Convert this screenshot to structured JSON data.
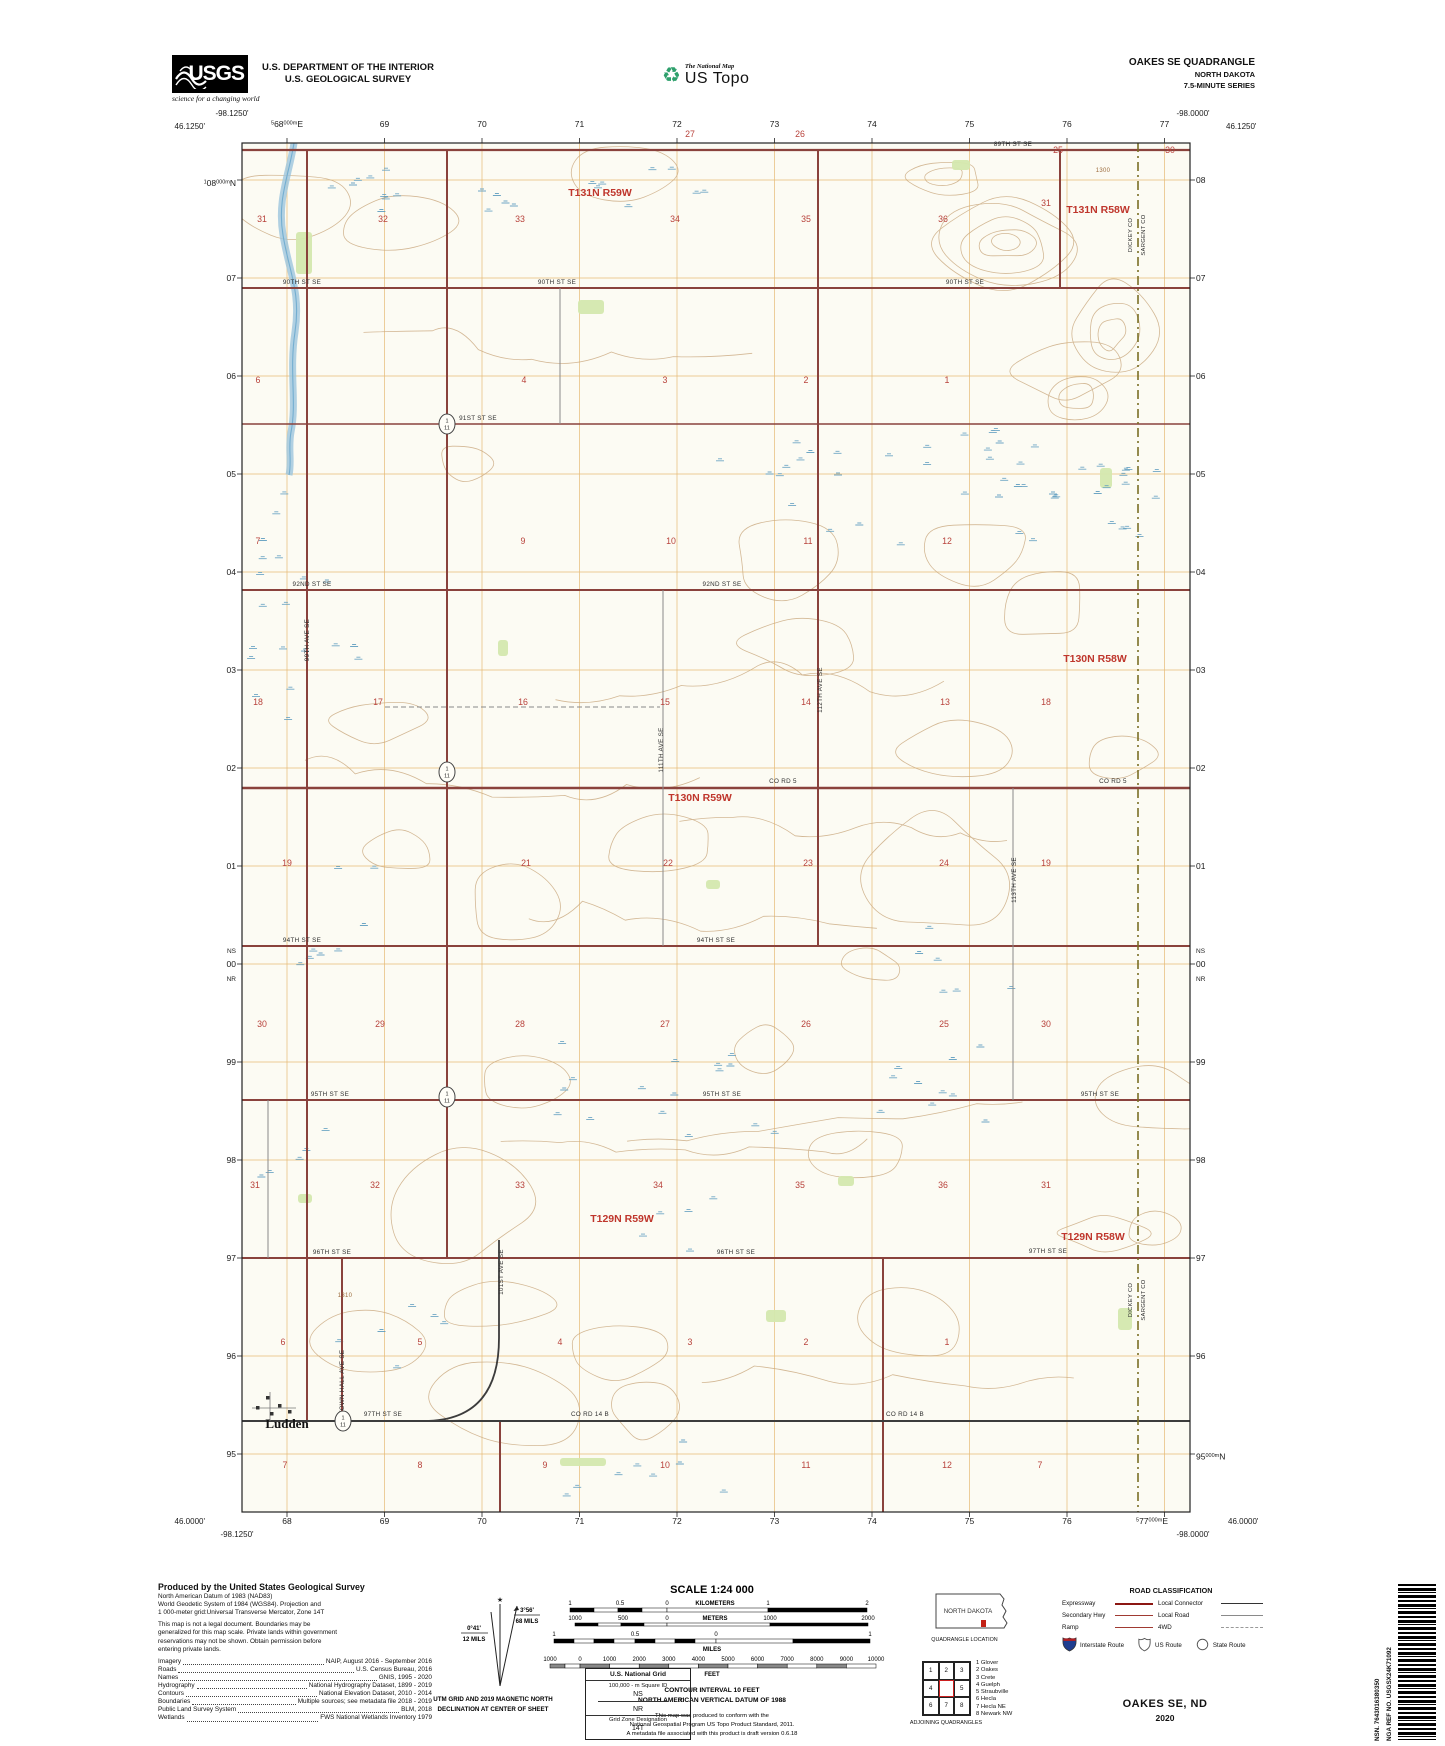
{
  "header": {
    "usgs_acronym": "USGS",
    "usgs_tagline": "science for a changing world",
    "dept_line1": "U.S. DEPARTMENT OF THE INTERIOR",
    "dept_line2": "U.S. GEOLOGICAL SURVEY",
    "tnm": "The National Map",
    "ustopo": "US Topo",
    "recycle_icon": "♻",
    "quad1": "OAKES SE QUADRANGLE",
    "quad2": "NORTH DAKOTA",
    "quad3": "7.5-MINUTE SERIES"
  },
  "map": {
    "corners": {
      "tl_lon": "-98.1250'",
      "tl_lat": "46.1250'",
      "tr_lon": "-98.0000'",
      "tr_lat": "46.1250'",
      "bl_lat": "46.0000'",
      "bl_lon": "-98.1250'",
      "br_lon": "-98.0000'",
      "br_lat": "46.0000'"
    },
    "utm": {
      "top_first": [
        "5",
        "68",
        "000m",
        "E"
      ],
      "top_rest": [
        "69",
        "70",
        "71",
        "72",
        "73",
        "74",
        "75",
        "76",
        "77"
      ],
      "bottom_rest": [
        "68",
        "69",
        "70",
        "71",
        "72",
        "73",
        "74",
        "75",
        "76"
      ],
      "bottom_last": [
        "5",
        "77",
        "000m",
        "E"
      ],
      "left_first": [
        "1",
        "08",
        "000m",
        "N"
      ],
      "left_rest": [
        "07",
        "06",
        "05",
        "04",
        "03",
        "02",
        "01",
        "00",
        "99",
        "98",
        "97",
        "96",
        "95"
      ],
      "right_rest": [
        "08",
        "07",
        "06",
        "05",
        "04",
        "03",
        "02",
        "01",
        "00",
        "99",
        "98",
        "97",
        "96"
      ],
      "right_last": [
        "",
        "95",
        "000m",
        "N"
      ],
      "ns": "NS",
      "nr": "NR"
    },
    "townships": [
      {
        "x": 600,
        "y": 196,
        "t": "T131N R59W"
      },
      {
        "x": 1098,
        "y": 213,
        "t": "T131N R58W"
      },
      {
        "x": 1095,
        "y": 662,
        "t": "T130N R58W"
      },
      {
        "x": 700,
        "y": 801,
        "t": "T130N R59W"
      },
      {
        "x": 622,
        "y": 1222,
        "t": "T129N R59W"
      },
      {
        "x": 1093,
        "y": 1240,
        "t": "T129N R58W"
      }
    ],
    "margin_sections": [
      {
        "n": "27",
        "x": 690,
        "y": 137
      },
      {
        "n": "26",
        "x": 800,
        "y": 137
      },
      {
        "n": "25",
        "x": 1058,
        "y": 153
      },
      {
        "n": "30",
        "x": 1170,
        "y": 153
      }
    ],
    "sections": [
      {
        "n": "31",
        "x": 262,
        "y": 222
      },
      {
        "n": "32",
        "x": 383,
        "y": 222
      },
      {
        "n": "33",
        "x": 520,
        "y": 222
      },
      {
        "n": "34",
        "x": 675,
        "y": 222
      },
      {
        "n": "35",
        "x": 806,
        "y": 222
      },
      {
        "n": "36",
        "x": 943,
        "y": 222
      },
      {
        "n": "31",
        "x": 1046,
        "y": 206
      },
      {
        "n": "6",
        "x": 258,
        "y": 383
      },
      {
        "n": "4",
        "x": 524,
        "y": 383
      },
      {
        "n": "3",
        "x": 665,
        "y": 383
      },
      {
        "n": "2",
        "x": 806,
        "y": 383
      },
      {
        "n": "1",
        "x": 947,
        "y": 383
      },
      {
        "n": "7",
        "x": 258,
        "y": 544
      },
      {
        "n": "9",
        "x": 523,
        "y": 544
      },
      {
        "n": "10",
        "x": 671,
        "y": 544
      },
      {
        "n": "11",
        "x": 808,
        "y": 544
      },
      {
        "n": "12",
        "x": 947,
        "y": 544
      },
      {
        "n": "18",
        "x": 258,
        "y": 705
      },
      {
        "n": "17",
        "x": 378,
        "y": 705
      },
      {
        "n": "16",
        "x": 523,
        "y": 705
      },
      {
        "n": "15",
        "x": 665,
        "y": 705
      },
      {
        "n": "14",
        "x": 806,
        "y": 705
      },
      {
        "n": "13",
        "x": 945,
        "y": 705
      },
      {
        "n": "18",
        "x": 1046,
        "y": 705
      },
      {
        "n": "19",
        "x": 287,
        "y": 866
      },
      {
        "n": "21",
        "x": 526,
        "y": 866
      },
      {
        "n": "22",
        "x": 668,
        "y": 866
      },
      {
        "n": "23",
        "x": 808,
        "y": 866
      },
      {
        "n": "24",
        "x": 944,
        "y": 866
      },
      {
        "n": "19",
        "x": 1046,
        "y": 866
      },
      {
        "n": "30",
        "x": 262,
        "y": 1027
      },
      {
        "n": "29",
        "x": 380,
        "y": 1027
      },
      {
        "n": "28",
        "x": 520,
        "y": 1027
      },
      {
        "n": "27",
        "x": 665,
        "y": 1027
      },
      {
        "n": "26",
        "x": 806,
        "y": 1027
      },
      {
        "n": "25",
        "x": 944,
        "y": 1027
      },
      {
        "n": "30",
        "x": 1046,
        "y": 1027
      },
      {
        "n": "31",
        "x": 255,
        "y": 1188
      },
      {
        "n": "32",
        "x": 375,
        "y": 1188
      },
      {
        "n": "33",
        "x": 520,
        "y": 1188
      },
      {
        "n": "34",
        "x": 658,
        "y": 1188
      },
      {
        "n": "35",
        "x": 800,
        "y": 1188
      },
      {
        "n": "36",
        "x": 943,
        "y": 1188
      },
      {
        "n": "31",
        "x": 1046,
        "y": 1188
      },
      {
        "n": "6",
        "x": 283,
        "y": 1345
      },
      {
        "n": "5",
        "x": 420,
        "y": 1345
      },
      {
        "n": "4",
        "x": 560,
        "y": 1345
      },
      {
        "n": "3",
        "x": 690,
        "y": 1345
      },
      {
        "n": "2",
        "x": 806,
        "y": 1345
      },
      {
        "n": "1",
        "x": 947,
        "y": 1345
      },
      {
        "n": "7",
        "x": 285,
        "y": 1468
      },
      {
        "n": "8",
        "x": 420,
        "y": 1468
      },
      {
        "n": "9",
        "x": 545,
        "y": 1468
      },
      {
        "n": "10",
        "x": 665,
        "y": 1468
      },
      {
        "n": "11",
        "x": 806,
        "y": 1468
      },
      {
        "n": "12",
        "x": 947,
        "y": 1468
      },
      {
        "n": "7",
        "x": 1040,
        "y": 1468
      }
    ],
    "road_labels": [
      {
        "t": "89TH ST SE",
        "x": 1013,
        "y": 146
      },
      {
        "t": "90TH ST SE",
        "x": 302,
        "y": 284
      },
      {
        "t": "90TH ST SE",
        "x": 557,
        "y": 284
      },
      {
        "t": "90TH ST SE",
        "x": 965,
        "y": 284
      },
      {
        "t": "91ST ST SE",
        "x": 478,
        "y": 420
      },
      {
        "t": "92ND ST SE",
        "x": 312,
        "y": 586
      },
      {
        "t": "92ND ST SE",
        "x": 722,
        "y": 586
      },
      {
        "t": "CO RD 5",
        "x": 783,
        "y": 783
      },
      {
        "t": "CO RD 5",
        "x": 1113,
        "y": 783
      },
      {
        "t": "94TH ST SE",
        "x": 302,
        "y": 942
      },
      {
        "t": "94TH ST SE",
        "x": 716,
        "y": 942
      },
      {
        "t": "95TH ST SE",
        "x": 330,
        "y": 1096
      },
      {
        "t": "95TH ST SE",
        "x": 722,
        "y": 1096
      },
      {
        "t": "95TH ST SE",
        "x": 1100,
        "y": 1096
      },
      {
        "t": "96TH ST SE",
        "x": 332,
        "y": 1254
      },
      {
        "t": "96TH ST SE",
        "x": 736,
        "y": 1254
      },
      {
        "t": "97TH ST SE",
        "x": 383,
        "y": 1416
      },
      {
        "t": "CO RD 14 B",
        "x": 590,
        "y": 1416
      },
      {
        "t": "CO RD 14 B",
        "x": 905,
        "y": 1416
      },
      {
        "t": "97TH ST SE",
        "x": 1048,
        "y": 1253
      },
      {
        "t": "111TH AVE SE",
        "x": 663,
        "y": 750,
        "rot": 1
      },
      {
        "t": "112TH AVE SE",
        "x": 822,
        "y": 690,
        "rot": 1
      },
      {
        "t": "113TH AVE SE",
        "x": 1016,
        "y": 880,
        "rot": 1
      },
      {
        "t": "99TH AVE SE",
        "x": 309,
        "y": 640,
        "rot": 1
      },
      {
        "t": "101ST AVE SE",
        "x": 503,
        "y": 1272,
        "rot": 1
      },
      {
        "t": "TOWN HALL AVE SE",
        "x": 344,
        "y": 1382,
        "rot": 1
      }
    ],
    "shields": [
      {
        "x": 447,
        "y": 424,
        "top": "1",
        "bot": "11"
      },
      {
        "x": 447,
        "y": 772,
        "top": "1",
        "bot": "11"
      },
      {
        "x": 447,
        "y": 1097,
        "top": "1",
        "bot": "11"
      },
      {
        "x": 343,
        "y": 1421,
        "top": "1",
        "bot": "11"
      }
    ],
    "county_labels": [
      {
        "x": 1132,
        "y": 235,
        "t": "DICKEY CO"
      },
      {
        "x": 1145,
        "y": 235,
        "t": "SARGENT CO"
      },
      {
        "x": 1132,
        "y": 1300,
        "t": "DICKEY CO"
      },
      {
        "x": 1145,
        "y": 1300,
        "t": "SARGENT CO"
      }
    ],
    "places": [
      {
        "x": 287,
        "y": 1428,
        "t": "Ludden"
      }
    ],
    "contour_labels": [
      {
        "x": 1103,
        "y": 172,
        "t": "1300"
      },
      {
        "x": 345,
        "y": 1297,
        "t": "1310"
      }
    ]
  },
  "produced": {
    "title": "Produced by the United States Geological Survey",
    "datum_lines": [
      "North American Datum of 1983 (NAD83)",
      "World Geodetic System of 1984 (WGS84).  Projection and",
      "1 000-meter grid:Universal Transverse Mercator, Zone 14T"
    ],
    "legal_lines": [
      "This map is not a legal document. Boundaries may be",
      "generalized for this map scale. Private lands within government",
      "reservations may not be shown. Obtain permission before",
      "entering private lands."
    ],
    "credits": [
      [
        "Imagery",
        "NAIP, August 2016 - September 2016"
      ],
      [
        "Roads",
        "U.S. Census Bureau, 2016"
      ],
      [
        "Names",
        "GNIS, 1995 - 2020"
      ],
      [
        "Hydrography",
        "National Hydrography Dataset, 1899 - 2019"
      ],
      [
        "Contours",
        "National Elevation Dataset, 2010 - 2014"
      ],
      [
        "Boundaries",
        "Multiple sources; see metadata file 2018 - 2019"
      ],
      [
        "Public Land Survey System",
        "BLM, 2018"
      ],
      [
        "Wetlands",
        "FWS National Wetlands Inventory 1979"
      ]
    ]
  },
  "declination": {
    "star": "★",
    "gn_deg": "0°41'",
    "gn_mils": "12 MILS",
    "mn_deg": "3°56'",
    "mn_mils": "68 MILS",
    "caption1": "UTM GRID AND 2019 MAGNETIC NORTH",
    "caption2": "DECLINATION AT CENTER OF SHEET"
  },
  "scale": {
    "title": "SCALE 1:24 000",
    "km_unit": "KILOMETERS",
    "km_labels": [
      "1",
      "0.5",
      "0",
      "1",
      "2"
    ],
    "m_unit": "METERS",
    "m_labels": [
      "1000",
      "500",
      "0",
      "1000",
      "2000"
    ],
    "mi_unit": "MILES",
    "mi_labels": [
      "1",
      "0.5",
      "0",
      "1"
    ],
    "ft_unit": "FEET",
    "ft_labels": [
      "1000",
      "0",
      "1000",
      "2000",
      "3000",
      "4000",
      "5000",
      "6000",
      "7000",
      "8000",
      "9000",
      "10000"
    ],
    "contour1": "CONTOUR INTERVAL 10 FEET",
    "contour2": "NORTH AMERICAN VERTICAL DATUM OF 1988",
    "conform": [
      "This map was produced to conform with the",
      "National Geospatial Program US Topo Product Standard, 2011.",
      "A metadata file associated with this product is draft version 0.6.18"
    ]
  },
  "usng": {
    "title": "U.S. National Grid",
    "square_label": "100,000 - m Square ID",
    "ns": "NS",
    "zero": "00",
    "nr": "NR",
    "zone_label": "Grid Zone Designation",
    "zone": "14T"
  },
  "locator": {
    "state": "NORTH DAKOTA",
    "caption": "QUADRANGLE LOCATION"
  },
  "adjoining": {
    "cells": [
      "1",
      "2",
      "3",
      "4",
      "5",
      "6",
      "7",
      "8"
    ],
    "caption": "ADJOINING QUADRANGLES",
    "list": [
      "1 Glover",
      "2 Oakes",
      "3 Crete",
      "4 Guelph",
      "5 Straubville",
      "6 Hecla",
      "7 Hecla NE",
      "8 Newark NW"
    ]
  },
  "roadclass": {
    "title": "ROAD CLASSIFICATION",
    "rows": [
      {
        "label": "Expressway",
        "style": "expressway"
      },
      {
        "label": "Local Connector",
        "style": "connector"
      },
      {
        "label": "Secondary Hwy",
        "style": "secondary"
      },
      {
        "label": "Local Road",
        "style": "local"
      },
      {
        "label": "Ramp",
        "style": "ramp"
      },
      {
        "label": "4WD",
        "style": "fourwd"
      }
    ],
    "routes": [
      {
        "label": "Interstate Route",
        "icon": "interstate-shield-icon"
      },
      {
        "label": "US Route",
        "icon": "us-route-shield-icon"
      },
      {
        "label": "State Route",
        "icon": "state-route-circle-icon"
      }
    ]
  },
  "titleblock": {
    "name": "OAKES SE,  ND",
    "year": "2020"
  },
  "barcode": {
    "nsn": "NSN. 7643016380350",
    "nga": "NGA REF NO. USGSX24K71092"
  },
  "colors": {
    "road_red": "#8a423c",
    "section_red": "#b8423b",
    "township_red": "#bf362c",
    "grid_orange": "#e4b467",
    "contour_brown": "#c9a87e",
    "water_blue": "#9cc6dd",
    "marsh_blue": "#5f9dc0",
    "county_olive": "#7a6f25",
    "paper": "#fcfbf3"
  }
}
